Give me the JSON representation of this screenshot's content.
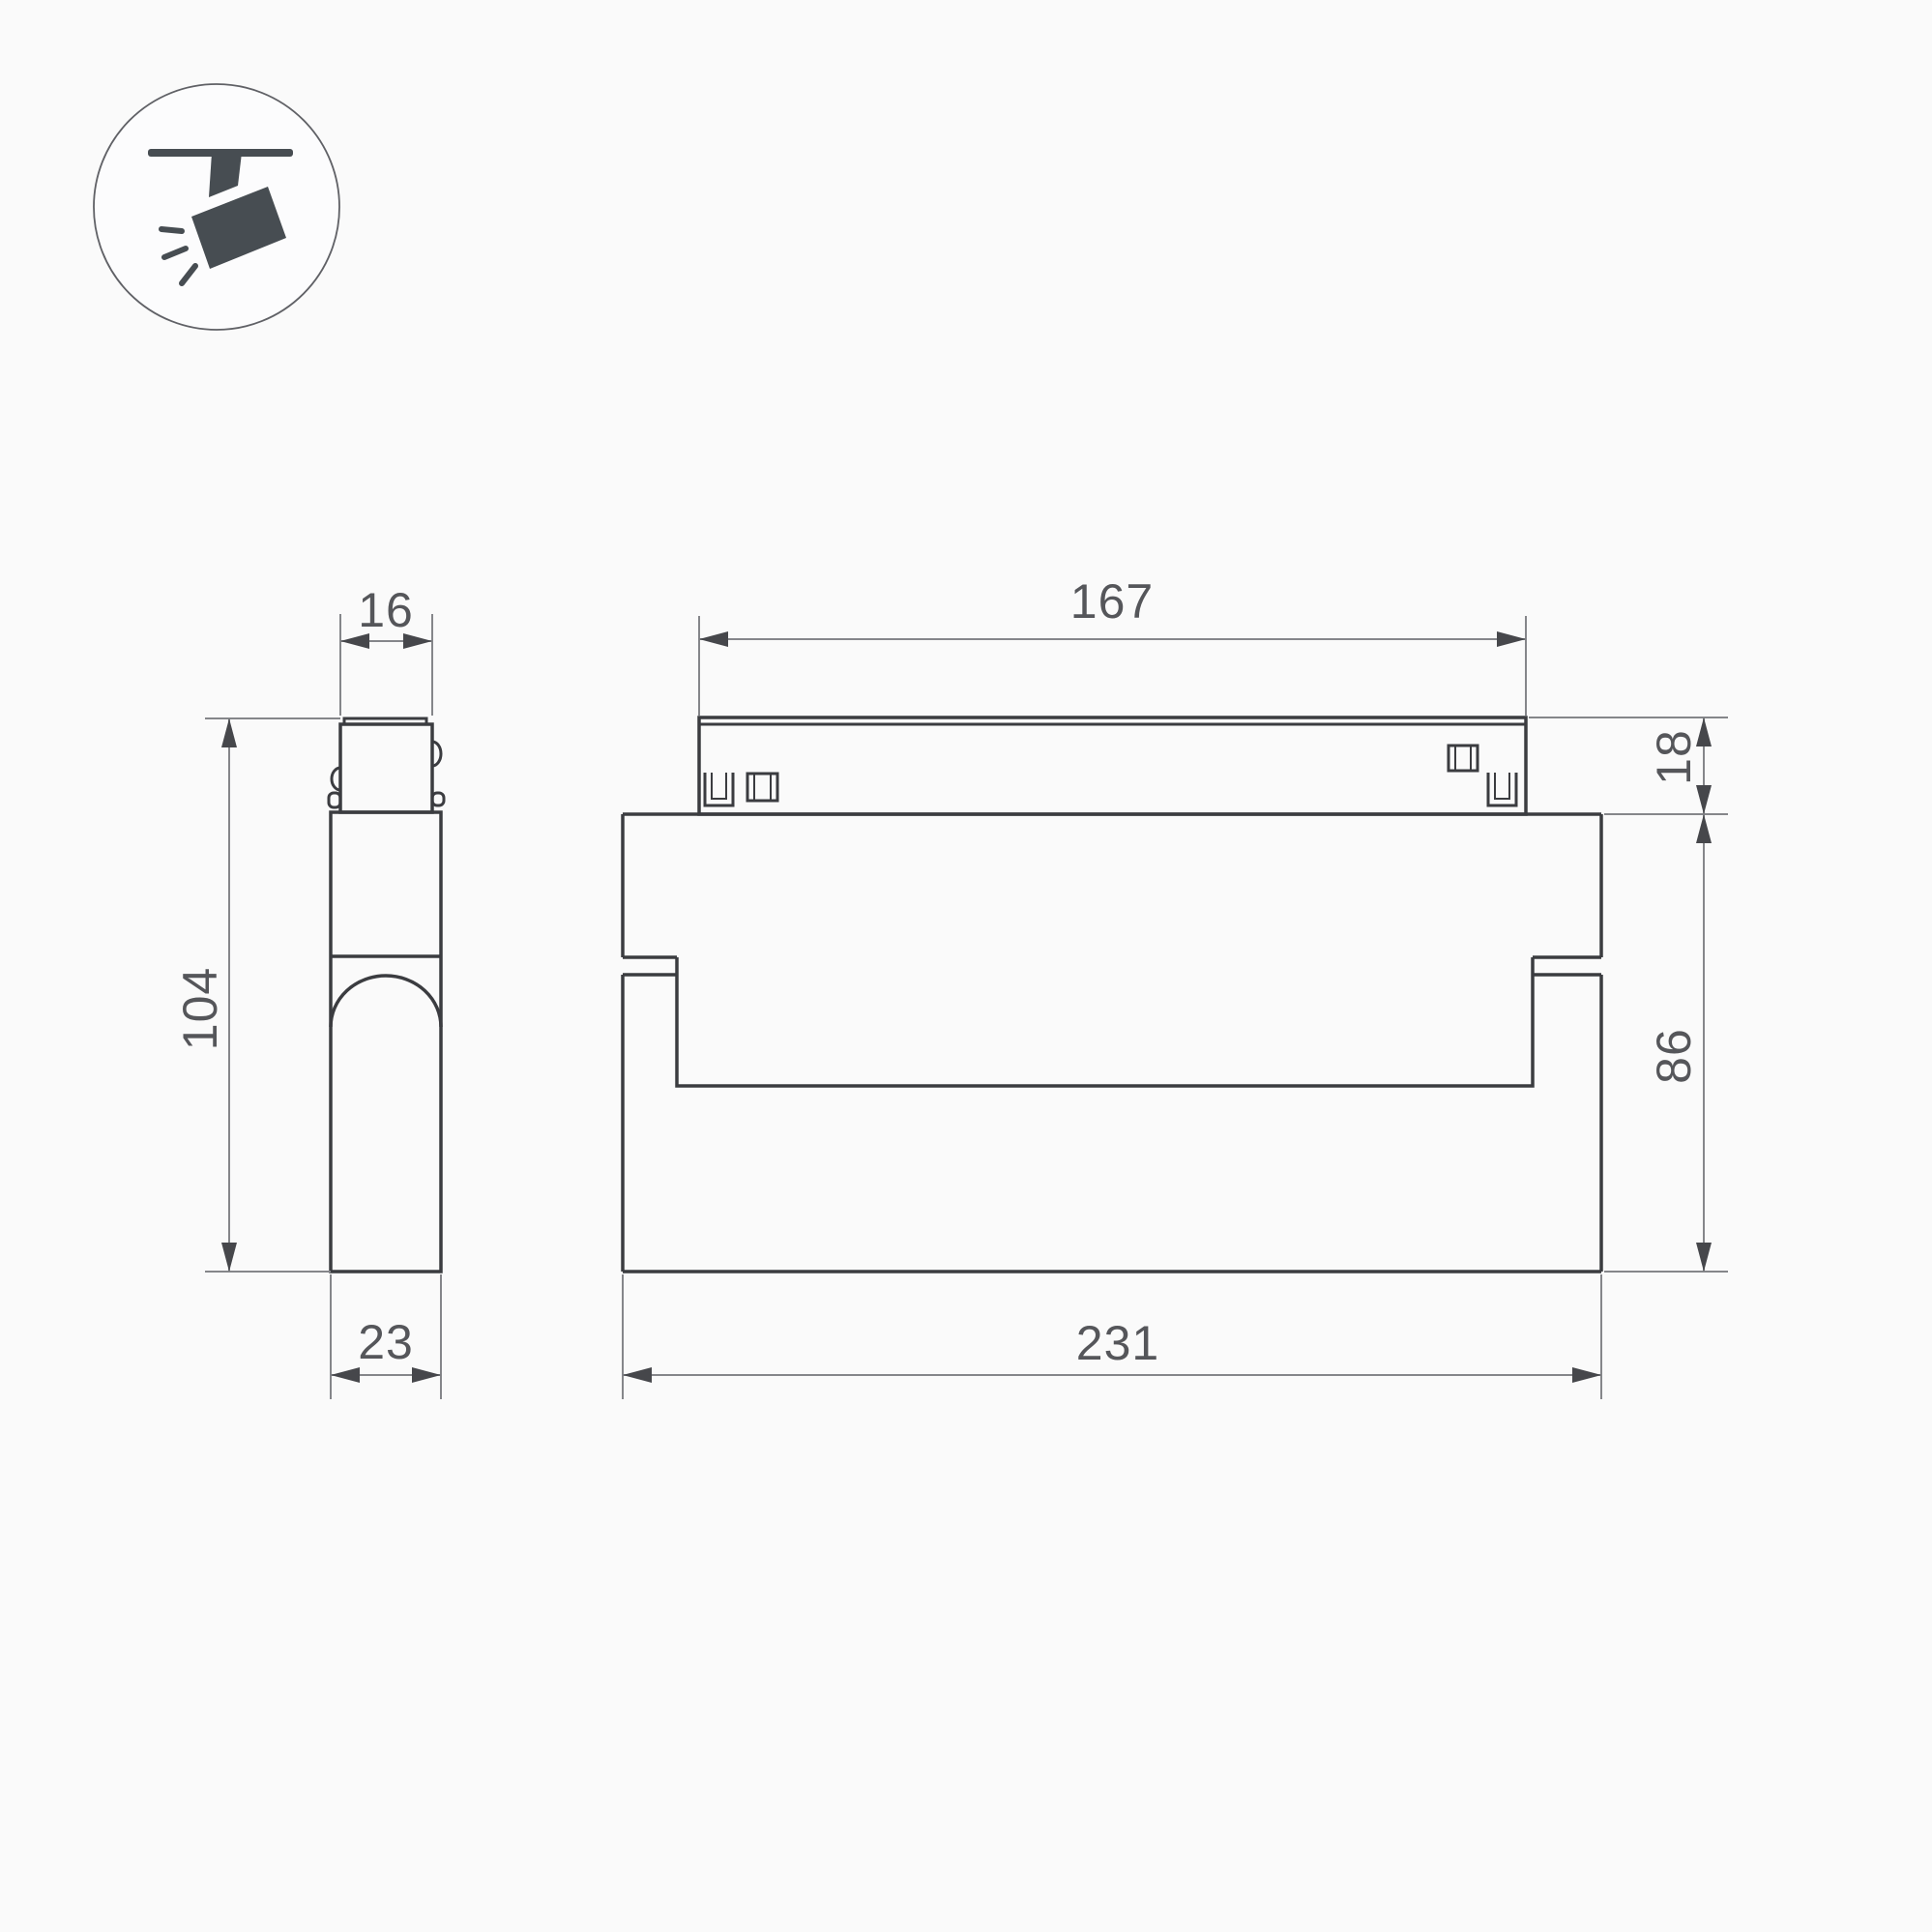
{
  "icon": {
    "name": "ceiling-track-spotlight-icon"
  },
  "views": {
    "side": {
      "dims": {
        "adapter_width": "16",
        "height": "104",
        "depth": "23"
      }
    },
    "front": {
      "dims": {
        "track_length": "167",
        "track_height": "18",
        "body_height": "86",
        "body_length": "231"
      }
    }
  },
  "colors": {
    "background": "#fafafa",
    "outline": "#3b3c40",
    "dimension_line": "#85868a",
    "arrowhead": "#46474b",
    "dimension_text": "#55565a",
    "icon": "#474d52"
  }
}
